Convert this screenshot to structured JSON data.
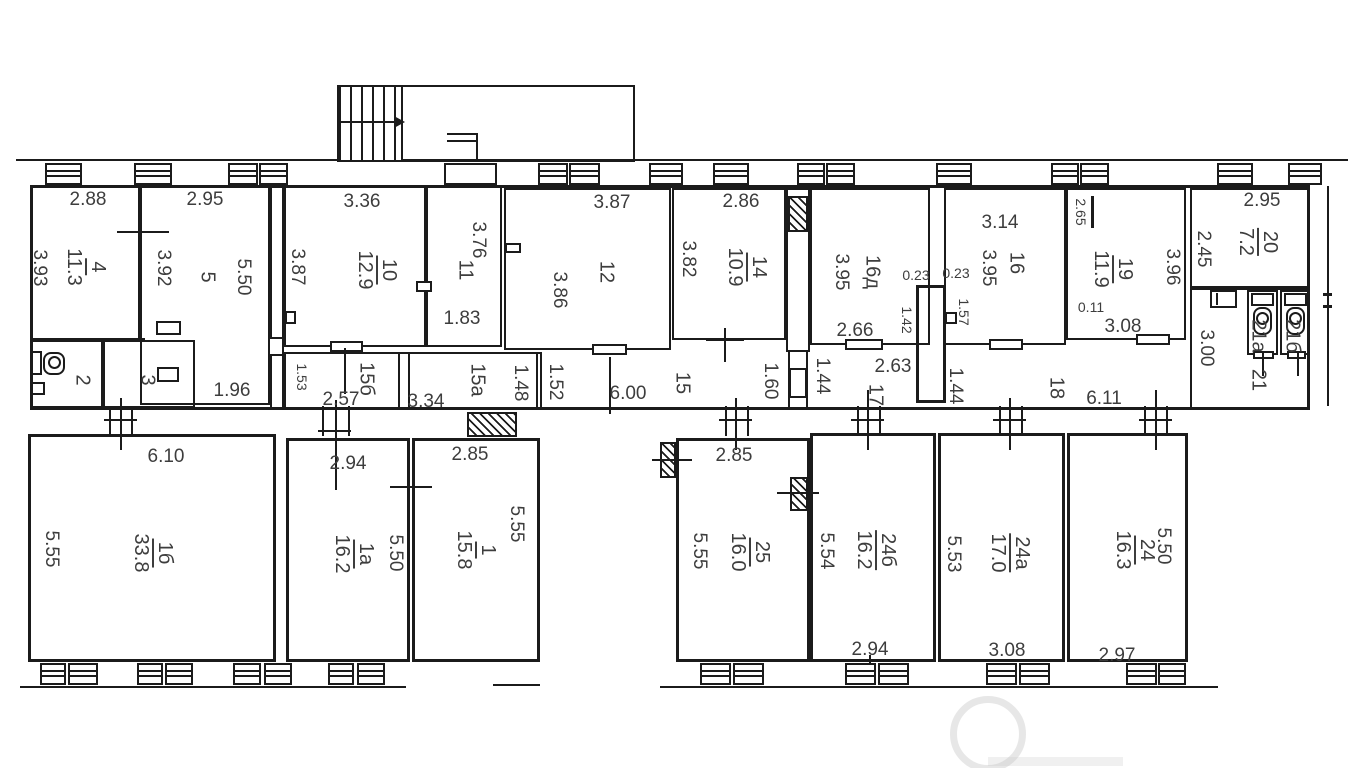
{
  "plan_title": "apartment-floor-plan",
  "rooms": {
    "r4": {
      "num": "4",
      "area": "11.3"
    },
    "r5": {
      "num": "5"
    },
    "r2": {
      "num": "2"
    },
    "r3": {
      "num": "3"
    },
    "r10": {
      "num": "10",
      "area": "12.9"
    },
    "r11": {
      "num": "11"
    },
    "r12": {
      "num": "12"
    },
    "r14": {
      "num": "14",
      "area": "10.9"
    },
    "r15": {
      "num": "15"
    },
    "r15a": {
      "num": "15а"
    },
    "r15b": {
      "num": "15б"
    },
    "r16d": {
      "num": "16д"
    },
    "r16": {
      "num": "16"
    },
    "r17": {
      "num": "17"
    },
    "r18": {
      "num": "18"
    },
    "r19": {
      "num": "19",
      "area": "11.9"
    },
    "r20": {
      "num": "20",
      "area": "7.2"
    },
    "r21": {
      "num": "21"
    },
    "r21a": {
      "num": "21а"
    },
    "r21b": {
      "num": "21б"
    },
    "r1b": {
      "num": "1б",
      "area": "33.8"
    },
    "r1a": {
      "num": "1а",
      "area": "16.2"
    },
    "r1": {
      "num": "1",
      "area": "15.8"
    },
    "r25": {
      "num": "25",
      "area": "16.0"
    },
    "r24b": {
      "num": "24б",
      "area": "16.2"
    },
    "r24a": {
      "num": "24а",
      "area": "17.0"
    },
    "r24": {
      "num": "24",
      "area": "16.3"
    }
  },
  "dims": {
    "r4_top": "2.88",
    "r4_left": "3.93",
    "r4_right": "3.92",
    "r5_top": "2.95",
    "r5_h": "5.50",
    "r5_bottom": "1.96",
    "r10_top": "3.36",
    "r10_left": "3.87",
    "r11_h": "3.76",
    "r11_bottom": "1.83",
    "r12_top": "3.87",
    "r12_left": "3.86",
    "r14_top": "2.86",
    "r14_left": "3.82",
    "r16d_left": "3.95",
    "r16d_bottom": "2.66",
    "wall_a": "0.23",
    "wall_b": "0.23",
    "shaft_w": "1.42",
    "r16_nook": "1.57",
    "r16_top": "3.14",
    "r16_left": "3.95",
    "r19_nook": "2.65",
    "r19_right": "3.96",
    "r19_step": "0.11",
    "r19_bottom": "3.08",
    "r20_top": "2.95",
    "r20_left": "2.45",
    "r21_h": "3.00",
    "c15b_left": "1.53",
    "c15b_w": "2.57",
    "c15a_w": "3.34",
    "c15a_right": "1.48",
    "c15_left": "1.52",
    "c15_w": "6.00",
    "c15_right": "1.60",
    "c17_left": "1.44",
    "c17_top": "2.63",
    "c18_left": "1.44",
    "c18_w": "6.11",
    "r1b_top": "6.10",
    "r1b_left": "5.55",
    "r1a_top": "2.94",
    "r1a_right": "5.50",
    "r1_top": "2.85",
    "r1_right": "5.55",
    "r25_top": "2.85",
    "r25_left": "5.55",
    "r24b_left": "5.54",
    "r24b_bottom": "2.94",
    "r24a_left": "5.53",
    "r24a_bottom": "3.08",
    "r24_right": "5.50",
    "r24_bottom": "2.97"
  },
  "colors": {
    "line": "#1b1b1b",
    "text": "#3d3d3d",
    "background": "#ffffff"
  }
}
